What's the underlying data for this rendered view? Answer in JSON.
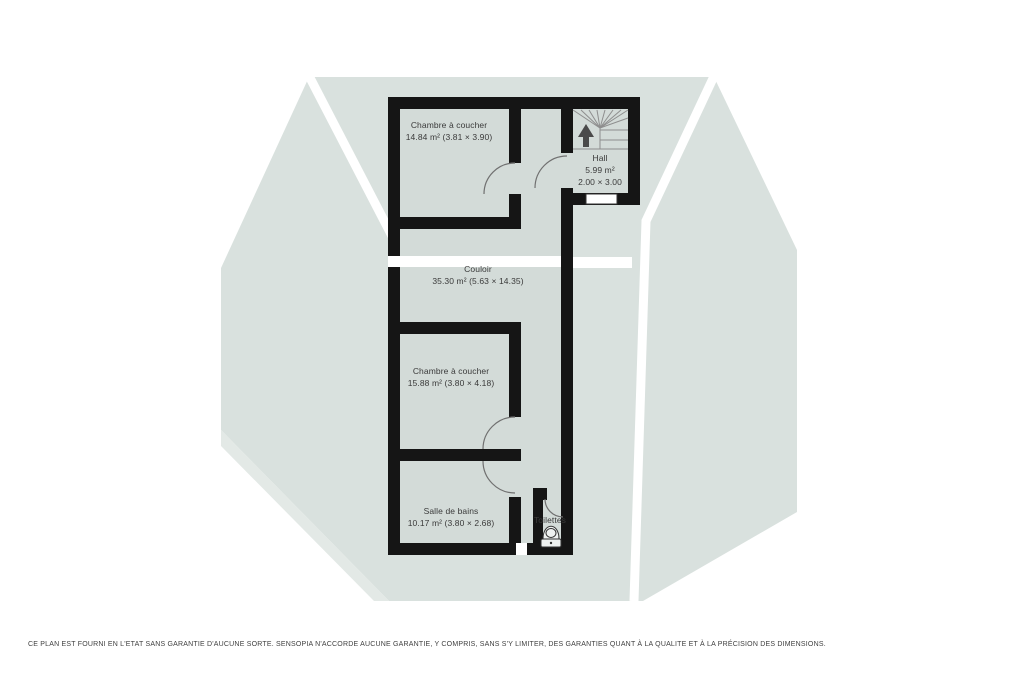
{
  "colors": {
    "roof_fill": "#d9e1de",
    "roof_highlight": "#e3e9e6",
    "floor_fill": "#d3dbd8",
    "wall": "#151515",
    "label_text": "#3a3a3a"
  },
  "rooms": {
    "bedroom1": {
      "name": "Chambre à coucher",
      "area": "14.84 m² (3.81 × 3.90)"
    },
    "hall": {
      "name": "Hall",
      "area": "5.99 m²",
      "dims": "2.00 × 3.00"
    },
    "corridor": {
      "name": "Couloir",
      "area": "35.30 m² (5.63 × 14.35)"
    },
    "bedroom2": {
      "name": "Chambre à coucher",
      "area": "15.88 m² (3.80 × 4.18)"
    },
    "bathroom": {
      "name": "Salle de bains",
      "area": "10.17 m² (3.80 × 2.68)"
    },
    "toilets": {
      "name": "Toilettes"
    }
  },
  "icons": {
    "stairs": "winder-staircase-with-up-arrow",
    "toilet": "toilet-top-view"
  },
  "footer": {
    "disclaimer": "CE PLAN EST FOURNI EN L'ETAT SANS GARANTIE D'AUCUNE SORTE. SENSOPIA N'ACCORDE AUCUNE GARANTIE, Y COMPRIS, SANS S'Y LIMITER, DES GARANTIES QUANT À LA QUALITE ET À LA PRÉCISION DES DIMENSIONS."
  }
}
